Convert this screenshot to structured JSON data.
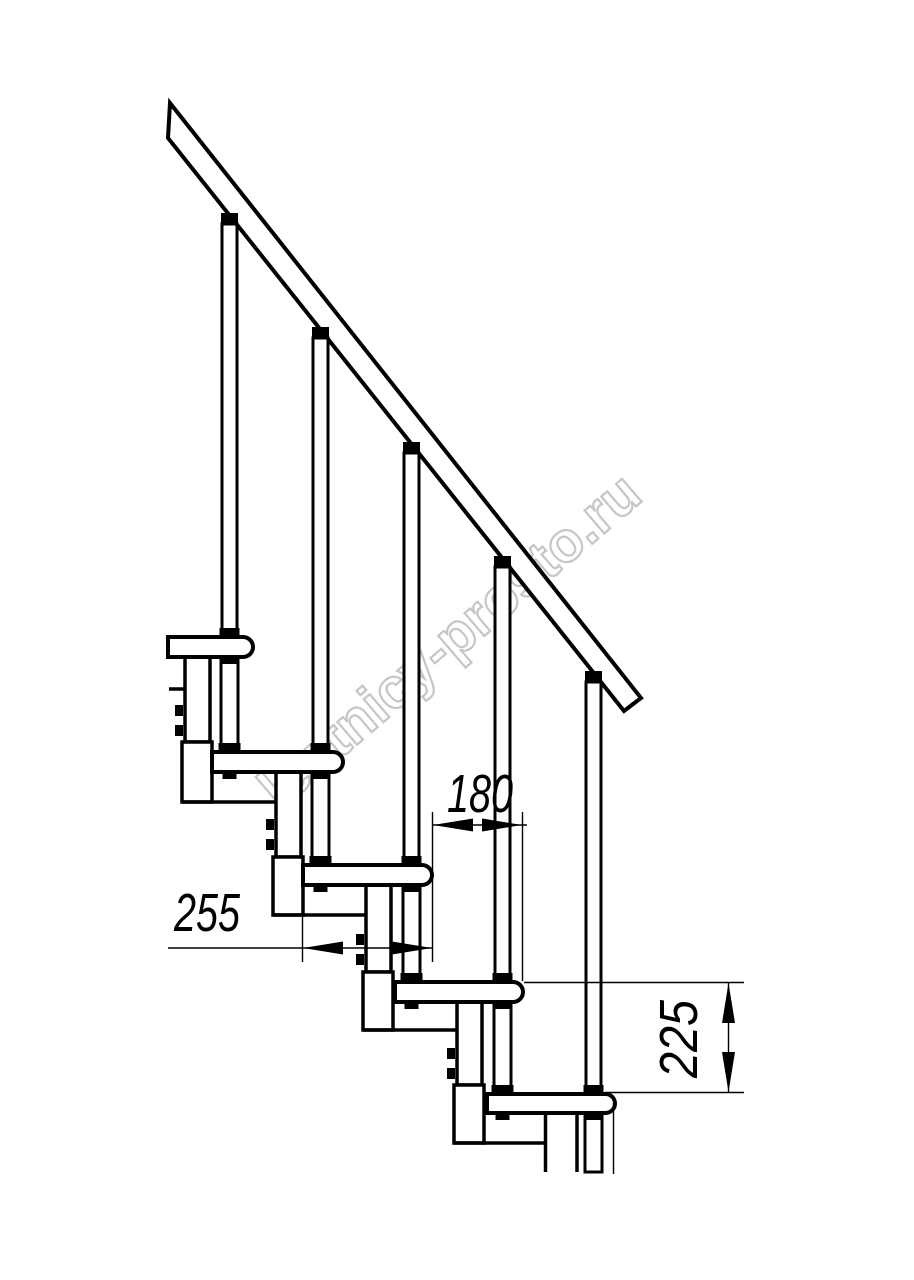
{
  "page": {
    "background": "#ffffff",
    "line_color": "#000000"
  },
  "watermark": {
    "text": "lestnicy-prosto.ru",
    "outline_color": "#c6c6c6",
    "fill_color": "#ffffff"
  },
  "drawing": {
    "type": "modular-staircase-side-elevation",
    "dimensions": [
      {
        "id": "tread-depth",
        "label": "255",
        "orientation": "horizontal"
      },
      {
        "id": "step-run",
        "label": "180",
        "orientation": "horizontal"
      },
      {
        "id": "step-rise",
        "label": "225",
        "orientation": "vertical"
      }
    ],
    "components": {
      "treads": 5,
      "balusters": 5,
      "support_modules": 5,
      "handrails": 1
    }
  }
}
